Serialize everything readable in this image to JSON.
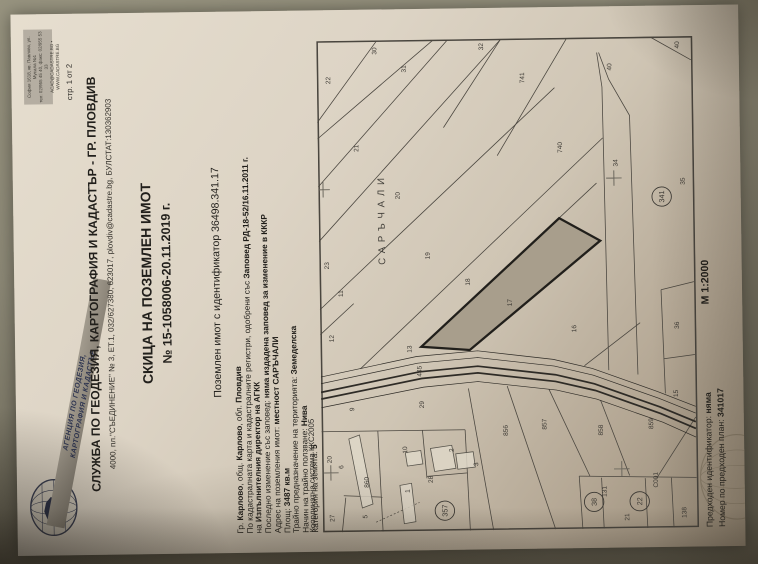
{
  "agency_logo": {
    "line1": "АГЕНЦИЯ ПО ГЕОДЕЗИЯ,",
    "line2": "КАРТОГРАФИЯ И КАДАСТЪР"
  },
  "hq_box": {
    "line1": "София 1618, кв. Павлово, ул. Мусала №1",
    "line2": "тел: 02/955 45 40, факс: 02/955 53 33",
    "line3": "ACAD@CADASTRE.BG • WWW.CADASTRE.BG"
  },
  "page_number": "стр. 1 от 2",
  "header": {
    "office": "СЛУЖБА ПО ГЕОДЕЗИЯ, КАРТОГРАФИЯ И КАДАСТЪР - ГР. ПЛОВДИВ",
    "address": "4000, пл.\"СЪЕДИНЕНИЕ\" № 3, ЕТ.1, 032/627380, 623017, plovdiv@cadastre.bg, БУЛСТАТ:130362903",
    "doc_title": "СКИЦА НА ПОЗЕМЛЕН ИМОТ",
    "doc_number": "№ 15-1058006-20.11.2019 г.",
    "parcel_id_line": "Поземлен имот с идентификатор 36498.341.17"
  },
  "info_lines": [
    [
      [
        "Гр. ",
        0
      ],
      [
        "Карлово",
        1
      ],
      [
        ", общ. ",
        0
      ],
      [
        "Карлово",
        1
      ],
      [
        ", обл. ",
        0
      ],
      [
        "Пловдив",
        1
      ]
    ],
    [
      [
        "По кадастралната карта и кадастралните регистри, одобрени със ",
        0
      ],
      [
        "Заповед РД-18-52/16.11.2011 г.",
        1
      ]
    ],
    [
      [
        "на ",
        0
      ],
      [
        "Изпълнителния директор на АГКК",
        1
      ]
    ],
    [
      [
        "Последно изменение със заповед: ",
        0
      ],
      [
        "няма издадена заповед за изменение в КККР",
        1
      ]
    ],
    [
      [
        "Адрес на поземления имот: ",
        0
      ],
      [
        "местност САРЪЧАЛИ",
        1
      ]
    ],
    [
      [
        "Площ: ",
        0
      ],
      [
        "3487 кв.м",
        1
      ]
    ],
    [
      [
        "Трайно предназначение на територията: ",
        0
      ],
      [
        "Земеделска",
        1
      ]
    ],
    [
      [
        "Начин на трайно ползване: ",
        0
      ],
      [
        "Нива",
        1
      ]
    ],
    [
      [
        "Категория на земята: ",
        0
      ],
      [
        "5",
        1
      ]
    ]
  ],
  "map": {
    "coord_system": "Координатна система ККС2005",
    "scale": "М 1:2000",
    "locality_label": "САРЪЧАЛИ",
    "subject_parcel": "17",
    "parcel_labels": [
      {
        "t": "22",
        "x": 467,
        "y": 14
      },
      {
        "t": "30",
        "x": 497,
        "y": 62
      },
      {
        "t": "31",
        "x": 478,
        "y": 92
      },
      {
        "t": "32",
        "x": 500,
        "y": 172
      },
      {
        "t": "21",
        "x": 396,
        "y": 42
      },
      {
        "t": "20",
        "x": 346,
        "y": 84
      },
      {
        "t": "19",
        "x": 283,
        "y": 114
      },
      {
        "t": "18",
        "x": 255,
        "y": 155
      },
      {
        "t": "17",
        "x": 233,
        "y": 198
      },
      {
        "t": "16",
        "x": 205,
        "y": 264
      },
      {
        "t": "15",
        "x": 136,
        "y": 368
      },
      {
        "t": "23",
        "x": 274,
        "y": 10
      },
      {
        "t": "11",
        "x": 245,
        "y": 24
      },
      {
        "t": "12",
        "x": 198,
        "y": 14
      },
      {
        "t": "13",
        "x": 186,
        "y": 94
      },
      {
        "t": "445",
        "x": 161,
        "y": 104
      },
      {
        "t": "9",
        "x": 126,
        "y": 34
      },
      {
        "t": "29",
        "x": 128,
        "y": 106
      },
      {
        "t": "741",
        "x": 465,
        "y": 214
      },
      {
        "t": "740",
        "x": 392,
        "y": 252
      },
      {
        "t": "40",
        "x": 477,
        "y": 304
      },
      {
        "t": "40",
        "x": 499,
        "y": 374
      },
      {
        "t": "34",
        "x": 377,
        "y": 309
      },
      {
        "t": "35",
        "x": 357,
        "y": 378
      },
      {
        "t": "36",
        "x": 207,
        "y": 370
      },
      {
        "t": "856",
        "x": 98,
        "y": 192
      },
      {
        "t": "857",
        "x": 104,
        "y": 232
      },
      {
        "t": "858",
        "x": 97,
        "y": 290
      },
      {
        "t": "859",
        "x": 103,
        "y": 342
      },
      {
        "t": "860",
        "x": 46,
        "y": 48
      },
      {
        "t": "6",
        "x": 66,
        "y": 22
      },
      {
        "t": "20",
        "x": 72,
        "y": 10
      },
      {
        "t": "28",
        "x": 50,
        "y": 114
      },
      {
        "t": "10",
        "x": 81,
        "y": 88
      },
      {
        "t": "1",
        "x": 40,
        "y": 90
      },
      {
        "t": "2",
        "x": 82,
        "y": 136
      },
      {
        "t": "3",
        "x": 67,
        "y": 161
      },
      {
        "t": "5",
        "x": 14,
        "y": 46
      },
      {
        "t": "27",
        "x": 11,
        "y": 12
      },
      {
        "t": "131",
        "x": 33,
        "y": 293
      },
      {
        "t": "21",
        "x": 8,
        "y": 316
      },
      {
        "t": "С001",
        "x": 42,
        "y": 346
      },
      {
        "t": "138",
        "x": 10,
        "y": 375
      }
    ],
    "circled_labels": [
      {
        "t": "341",
        "x": 345,
        "y": 354
      },
      {
        "t": "357",
        "x": 21,
        "y": 126
      },
      {
        "t": "38",
        "x": 28,
        "y": 280
      },
      {
        "t": "22",
        "x": 28,
        "y": 327
      }
    ]
  },
  "footer": {
    "prev_id_label": "Предходен идентификатор: ",
    "prev_id_value": "няма",
    "prev_plan_label": "Номер по предходен план: ",
    "prev_plan_value": "341017"
  }
}
